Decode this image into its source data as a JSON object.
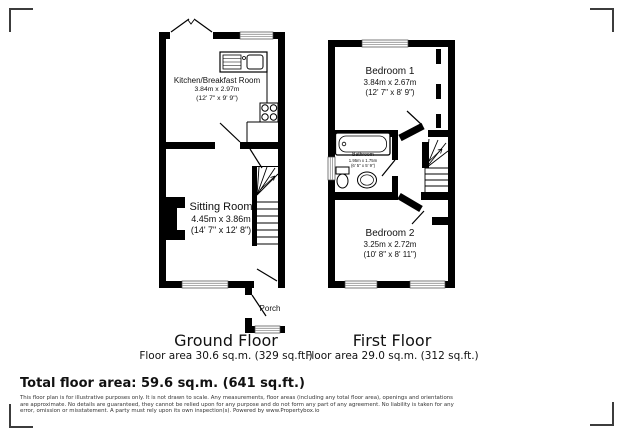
{
  "ground": {
    "title": "Ground Floor",
    "area": "Floor area 30.6 sq.m. (329 sq.ft.)",
    "rooms": {
      "kitchen": {
        "name": "Kitchen/Breakfast Room",
        "metric": "3.84m x 2.97m",
        "imperial": "(12' 7\" x 9' 9\")"
      },
      "sitting": {
        "name": "Sitting Room",
        "metric": "4.45m x 3.86m",
        "imperial": "(14' 7\" x 12' 8\")"
      },
      "porch": {
        "name": "Porch"
      }
    }
  },
  "first": {
    "title": "First Floor",
    "area": "Floor area 29.0 sq.m. (312 sq.ft.)",
    "rooms": {
      "bedroom1": {
        "name": "Bedroom 1",
        "metric": "3.84m x 2.67m",
        "imperial": "(12' 7\" x 8' 9\")"
      },
      "bathroom": {
        "name": "Bathroom",
        "metric": "1.95m x 1.75m",
        "imperial": "(6' 5\" x 5' 9\")"
      },
      "bedroom2": {
        "name": "Bedroom 2",
        "metric": "3.25m x 2.72m",
        "imperial": "(10' 8\" x 8' 11\")"
      }
    }
  },
  "total": "Total floor area: 59.6 sq.m. (641 sq.ft.)",
  "disclaimer": "This floor plan is for illustrative purposes only. It is not drawn to scale. Any measurements, floor areas (including any total floor area), openings and orientations are approximate. No details are guaranteed, they cannot be relied upon for any purpose and do not form any part of any agreement. No liability is taken for any error, omission or misstatement. A party must rely upon its own inspection(s). Powered by www.Propertybox.io"
}
